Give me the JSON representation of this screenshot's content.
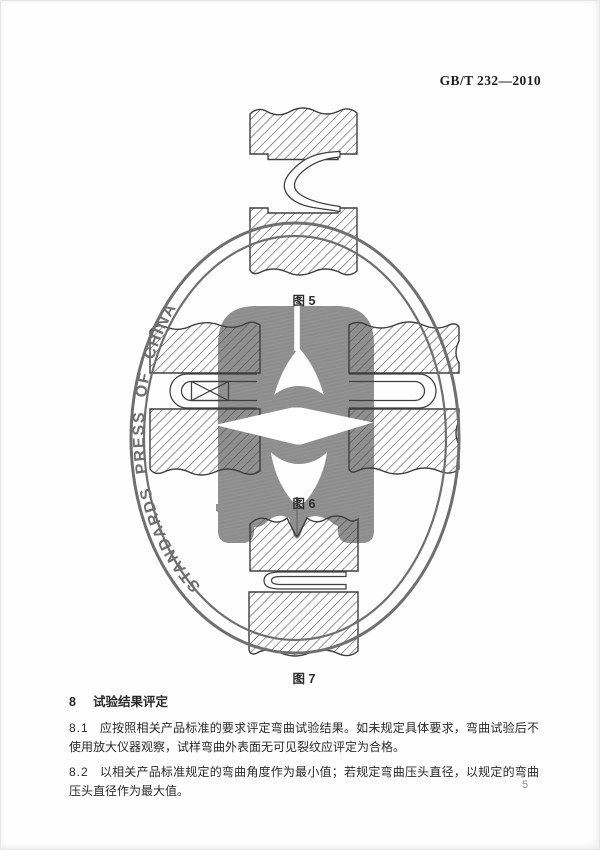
{
  "page": {
    "header_code": "GB/T 232—2010",
    "page_number": "5",
    "background_color": "#fefefe",
    "text_color": "#2a2a2a"
  },
  "watermark": {
    "text": "STANDARDS PRESS OF CHINA",
    "ring_color": "#6f6f6f",
    "text_color": "#6f6f6f",
    "ornament_color": "#8e8e8e"
  },
  "figures": {
    "fig5": {
      "label": "图 5"
    },
    "fig6": {
      "label": "图 6"
    },
    "fig7": {
      "label": "图 7"
    }
  },
  "section": {
    "heading_number": "8",
    "heading_title": "试验结果评定",
    "clauses": [
      {
        "number": "8.1",
        "text": "应按照相关产品标准的要求评定弯曲试验结果。如未规定具体要求，弯曲试验后不使用放大仪器观察，试样弯曲外表面无可见裂纹应评定为合格。"
      },
      {
        "number": "8.2",
        "text": "以相关产品标准规定的弯曲角度作为最小值；若规定弯曲压头直径，以规定的弯曲压头直径作为最大值。"
      }
    ]
  }
}
